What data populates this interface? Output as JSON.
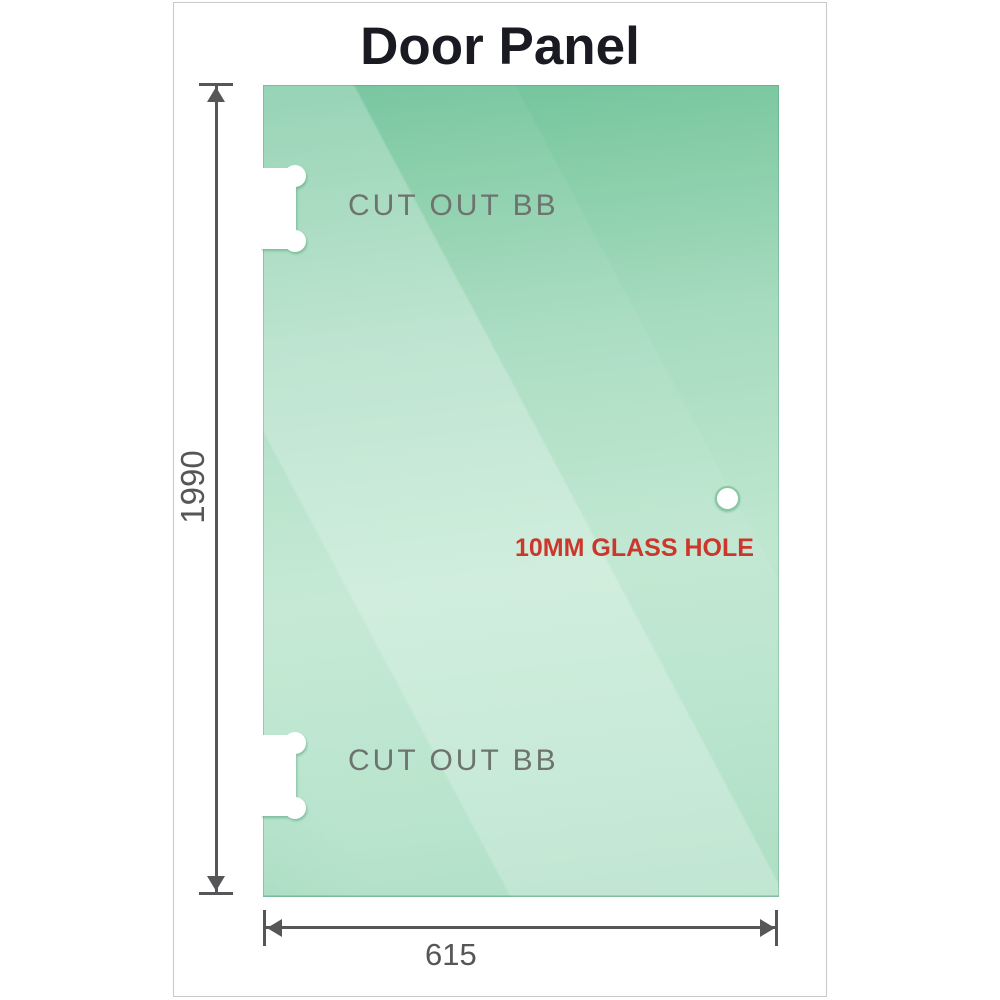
{
  "title": "Door Panel",
  "panel": {
    "cutout_top_label": "CUT OUT BB",
    "cutout_bottom_label": "CUT OUT BB",
    "hole_label": "10MM GLASS HOLE"
  },
  "dimensions": {
    "height_label": "1990",
    "width_label": "615"
  },
  "colors": {
    "glass_dark": "#6ec29a",
    "glass_light": "#bfe7d0",
    "hole_ring": "#86c7a6",
    "hole_label_color": "#cb372d",
    "cutout_label_color": "#6e736f",
    "dim_color": "#565659",
    "title_color": "#1a1a22",
    "frame_border": "#c9c9c9"
  }
}
